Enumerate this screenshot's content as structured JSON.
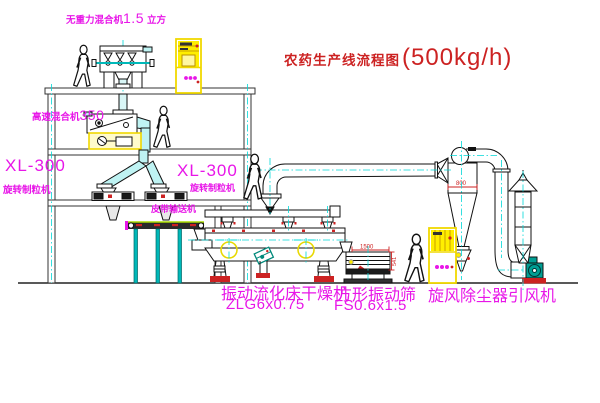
{
  "title": {
    "cn": "农药生产线流程图",
    "capacity": "(500kg/h)"
  },
  "labels": {
    "top_mixer": {
      "name": "无重力混合机",
      "size": "1.5",
      "unit": "立方"
    },
    "high_speed_mixer": {
      "name": "高速混合机",
      "size": "350"
    },
    "granulator_left": {
      "model": "XL-300",
      "name": "旋转制粒机"
    },
    "granulator_right": {
      "model": "XL-300",
      "name": "旋转制粒机"
    },
    "belt_conveyor": {
      "name": "皮带输送机"
    },
    "fluid_bed_dryer": {
      "name": "振动流化床干燥机",
      "model": "ZLG6x0.75"
    },
    "vibrating_screen": {
      "name": "方形振动筛",
      "model": "FS0.6x1.5"
    },
    "cyclone": {
      "name": "旋风除尘器"
    },
    "fan": {
      "name": "引风机"
    }
  },
  "dimensions": {
    "cyclone_width": "800",
    "screen_length": "1500",
    "screen_height": "541"
  },
  "colors": {
    "label": "#e816e8",
    "title": "#cc2222",
    "centerline": "#00d8d8",
    "highlight": "#ffee00",
    "teal": "#009e93",
    "red": "#cc2222"
  }
}
